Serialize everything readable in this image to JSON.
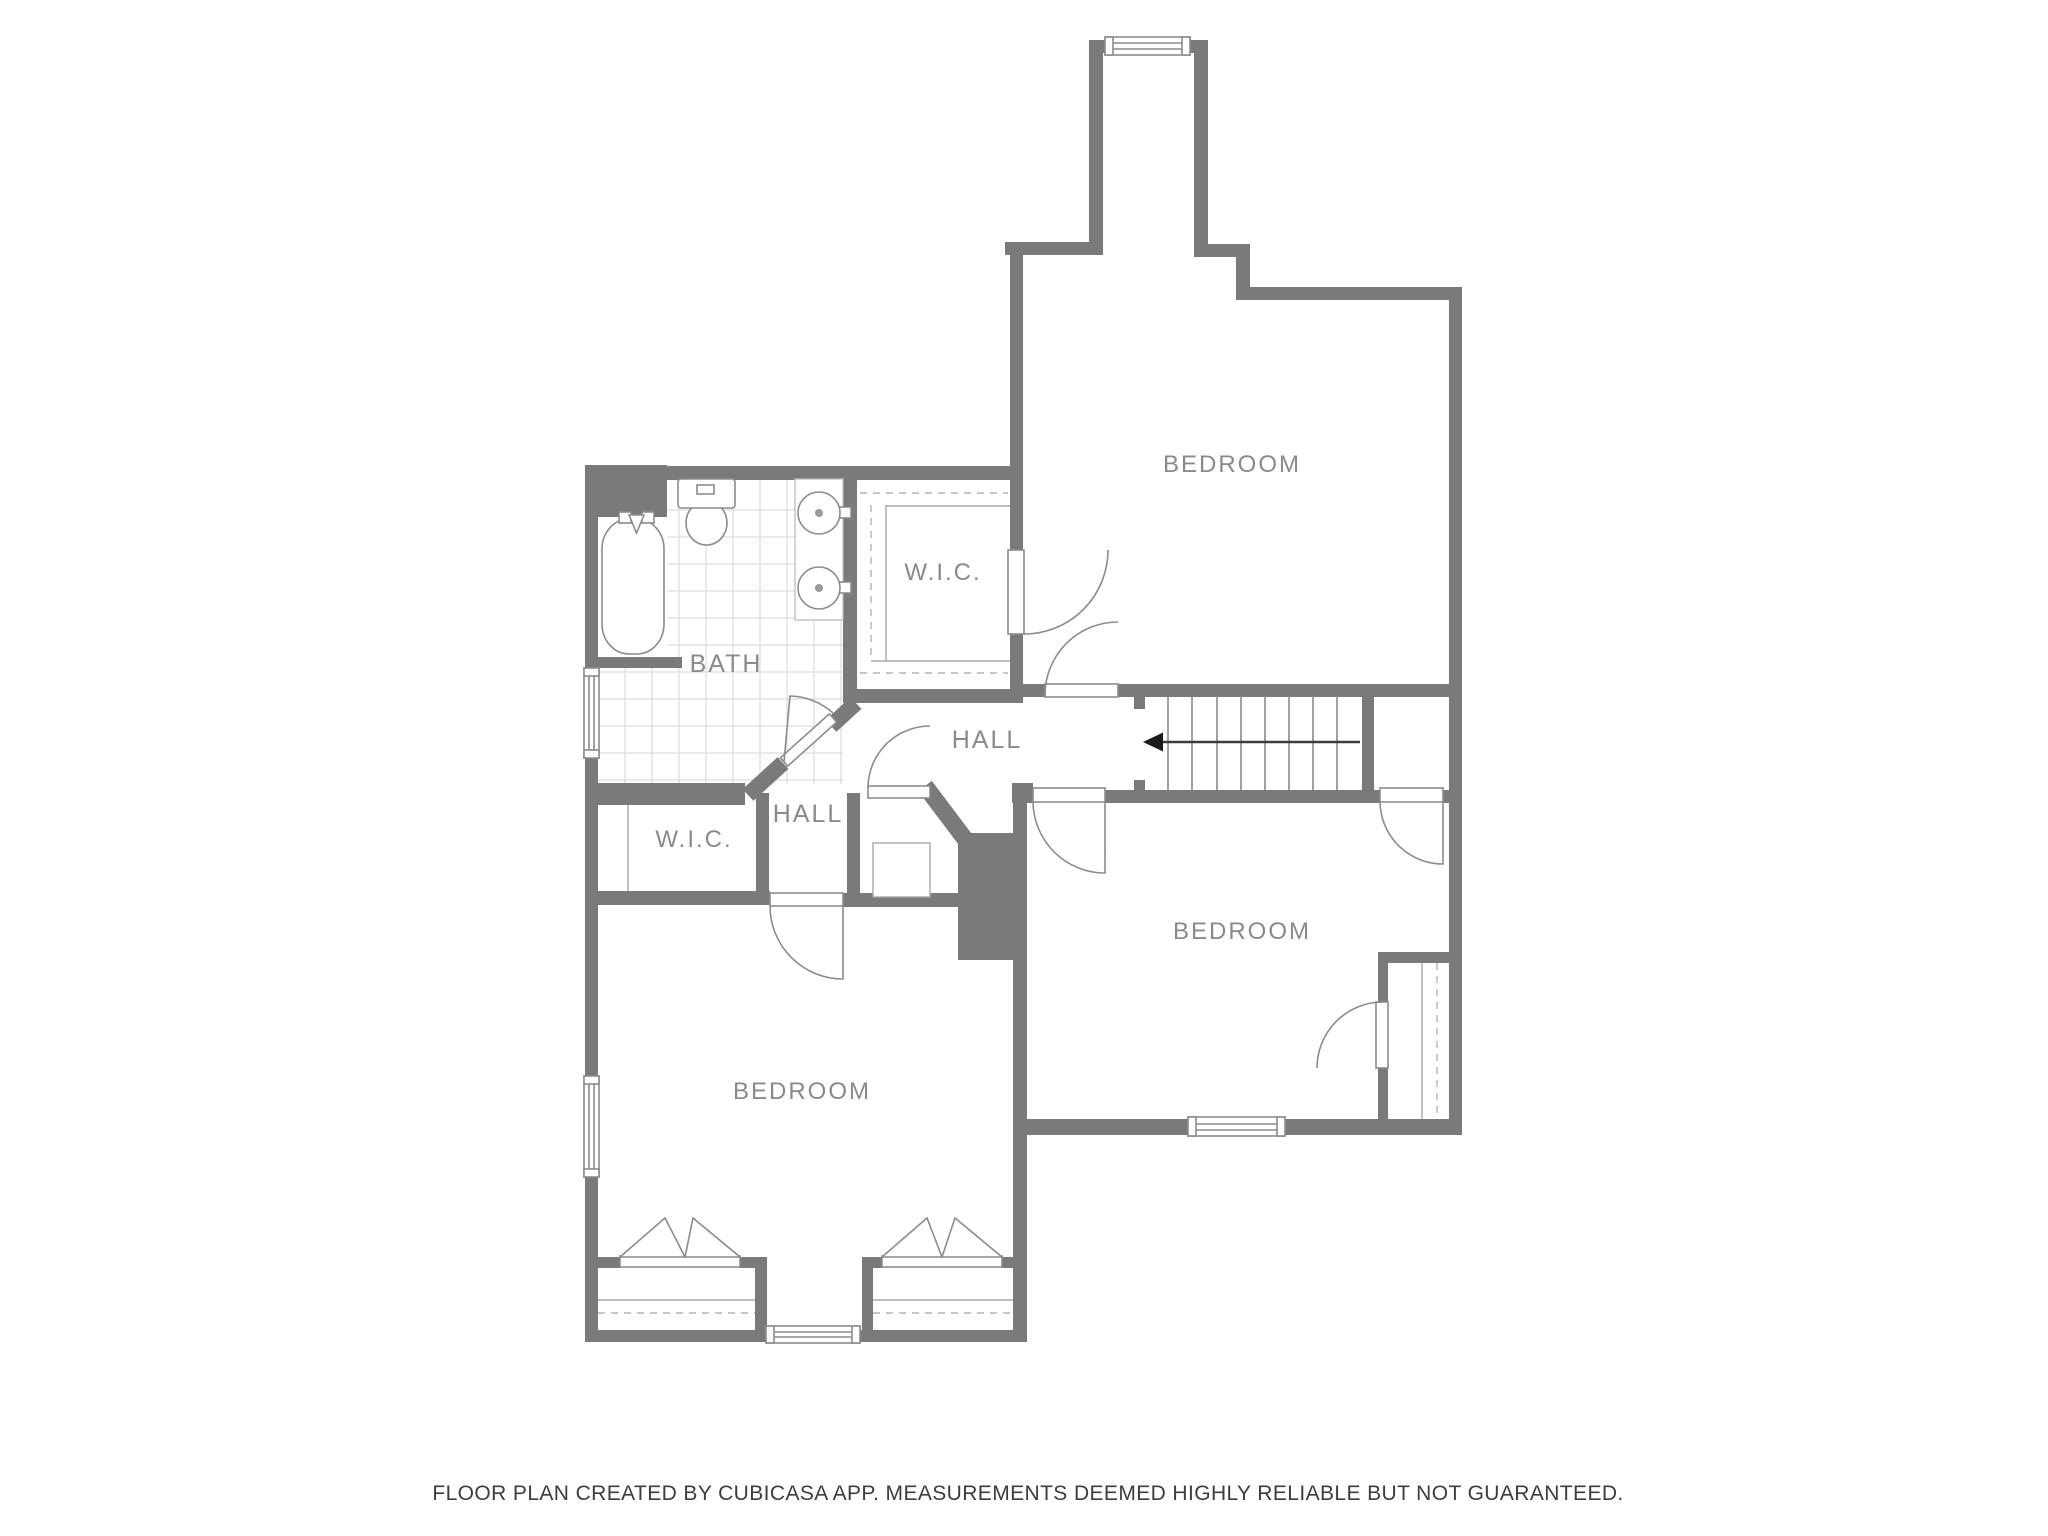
{
  "canvas": {
    "width": 2048,
    "height": 1536,
    "background": "#ffffff"
  },
  "colors": {
    "wall": "#7a7a7a",
    "fixture_outline": "#8c8c8c",
    "closet_line": "#a8a8a8",
    "tile_line": "#d6d6d6",
    "dashed_line": "#b3b3b3",
    "room_label": "#8a8a8a",
    "footer_text": "#3d3d3d",
    "stair_arrow": "#1a1a1a"
  },
  "rooms": [
    {
      "id": "bedroom_top",
      "label": "BEDROOM"
    },
    {
      "id": "wic_top",
      "label": "W.I.C."
    },
    {
      "id": "bath",
      "label": "BATH"
    },
    {
      "id": "hall_main",
      "label": "HALL"
    },
    {
      "id": "hall_lower",
      "label": "HALL"
    },
    {
      "id": "wic_lower",
      "label": "W.I.C."
    },
    {
      "id": "bedroom_right",
      "label": "BEDROOM"
    },
    {
      "id": "bedroom_bottom_left",
      "label": "BEDROOM"
    }
  ],
  "fixtures": [
    "bathtub",
    "toilet",
    "double-vanity-sinks",
    "staircase-down-arrow",
    "bifold-closet-doors",
    "hinged-doors",
    "windows"
  ],
  "stairs": {
    "tread_count": 9,
    "arrow_direction": "left"
  },
  "footer": {
    "disclaimer": "FLOOR PLAN CREATED BY CUBICASA APP. MEASUREMENTS DEEMED HIGHLY RELIABLE BUT NOT GUARANTEED."
  }
}
